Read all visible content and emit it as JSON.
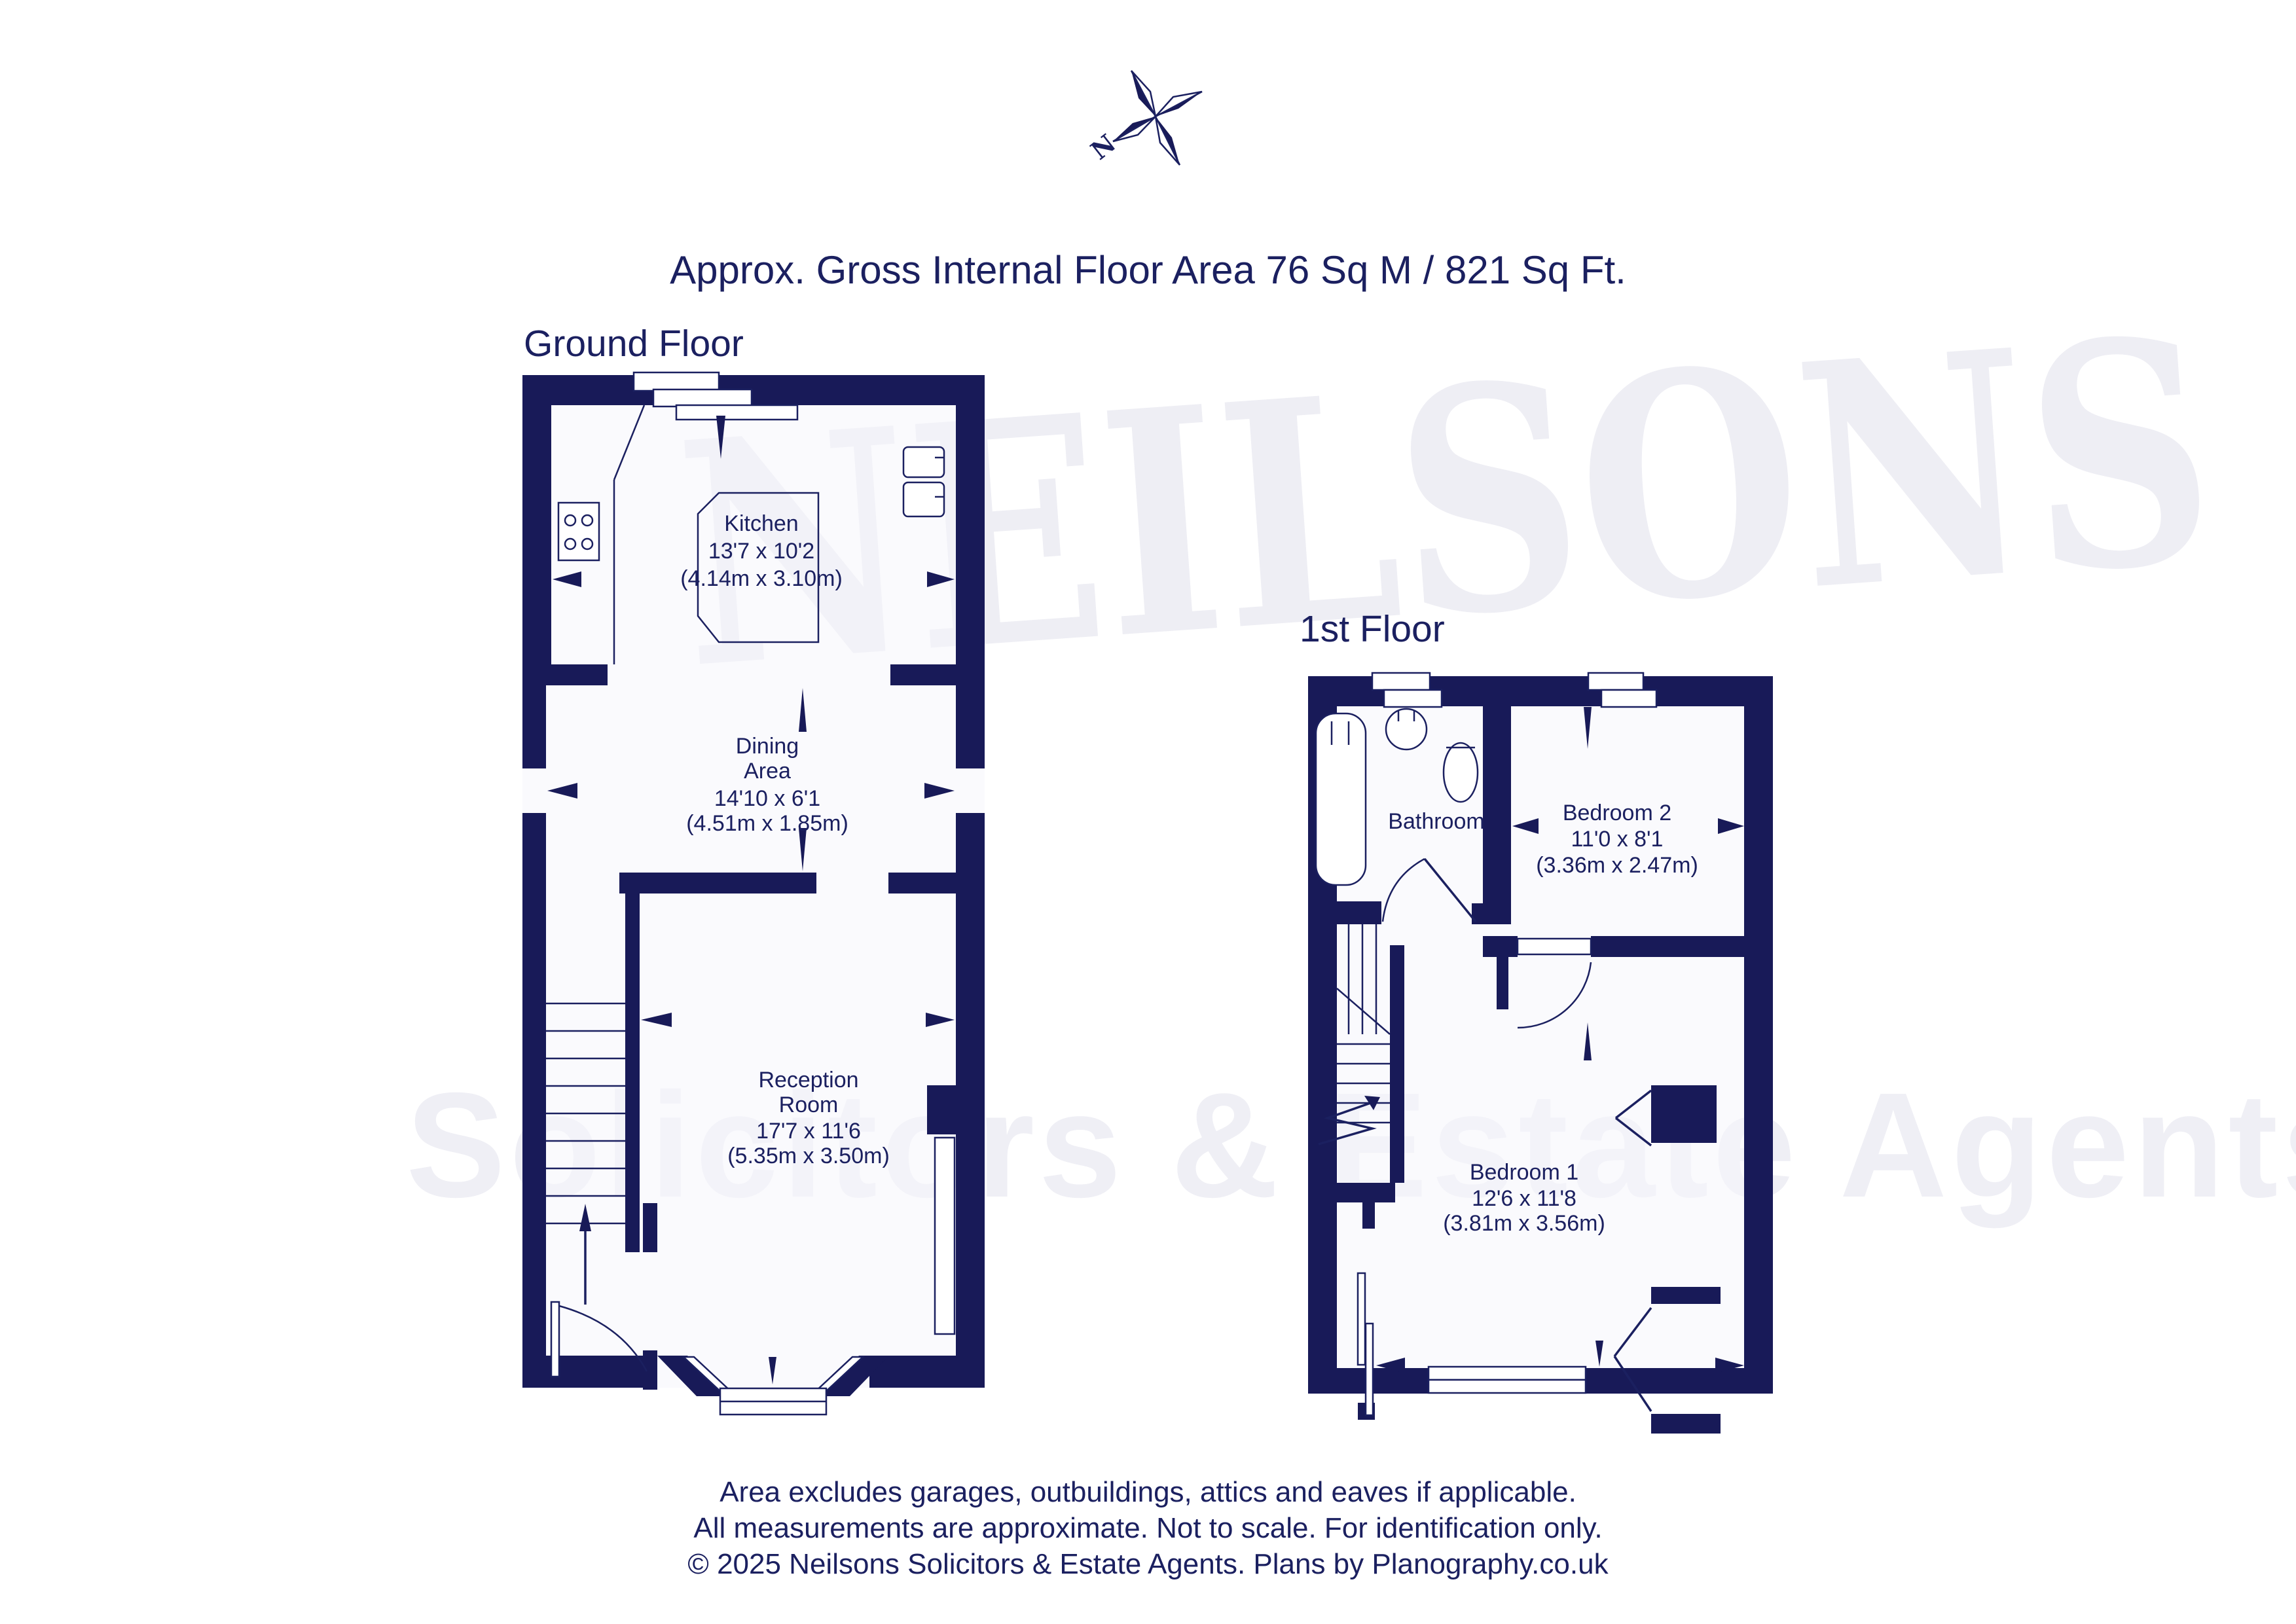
{
  "title": "Approx. Gross Internal Floor Area 76 Sq M / 821 Sq Ft.",
  "compass": {
    "north_label": "N"
  },
  "watermark": {
    "line1": "NEILSONS",
    "line2": "Solicitors & Estate Agents"
  },
  "colors": {
    "wall": "#181a58",
    "text": "#1b2060",
    "watermark": "#eeeef4"
  },
  "floors": [
    {
      "label": "Ground Floor",
      "rooms": [
        {
          "name": "Kitchen",
          "dims_imperial": "13'7 x 10'2",
          "dims_metric": "(4.14m x 3.10m)"
        },
        {
          "name_line1": "Dining",
          "name_line2": "Area",
          "dims_imperial": "14'10 x 6'1",
          "dims_metric": "(4.51m x 1.85m)"
        },
        {
          "name_line1": "Reception",
          "name_line2": "Room",
          "dims_imperial": "17'7 x 11'6",
          "dims_metric": "(5.35m x 3.50m)"
        }
      ]
    },
    {
      "label": "1st Floor",
      "rooms": [
        {
          "name": "Bathroom"
        },
        {
          "name": "Bedroom 2",
          "dims_imperial": "11'0 x 8'1",
          "dims_metric": "(3.36m x 2.47m)"
        },
        {
          "name": "Bedroom 1",
          "dims_imperial": "12'6 x 11'8",
          "dims_metric": "(3.81m x 3.56m)"
        }
      ]
    }
  ],
  "footer": {
    "line1": "Area excludes garages, outbuildings, attics and eaves if applicable.",
    "line2": "All measurements are approximate. Not to scale. For identification only.",
    "line3": "© 2025 Neilsons Solicitors & Estate Agents. Plans by Planography.co.uk"
  }
}
